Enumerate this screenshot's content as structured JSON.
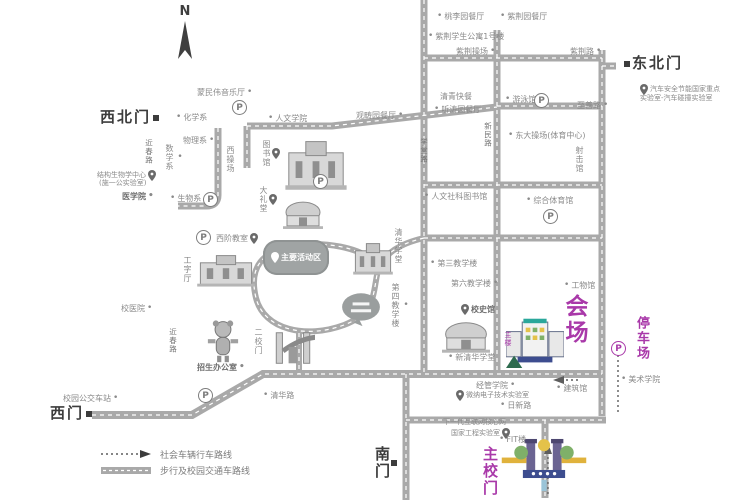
{
  "compass_label": "N",
  "colors": {
    "road": "#a9a9a9",
    "label": "#8a8a8a",
    "dark": "#3c3c3c",
    "accent": "#a939a9"
  },
  "legend": {
    "items": [
      {
        "icon": "dotted-route-icon",
        "label": "社会车辆行车路线"
      },
      {
        "icon": "road-icon",
        "label": "步行及校园交通车路线"
      }
    ]
  },
  "labels": [
    {
      "name": "northwest-gate",
      "text": "西北门",
      "x": 100,
      "y": 110,
      "cls": "gate",
      "marker": "sq-right"
    },
    {
      "name": "northeast-gate",
      "text": "东北门",
      "x": 624,
      "y": 56,
      "cls": "gate",
      "marker": "sq-left"
    },
    {
      "name": "west-gate",
      "text": "西门",
      "x": 50,
      "y": 406,
      "cls": "gate",
      "marker": "sq-right"
    },
    {
      "name": "south-gate",
      "text": "南门",
      "x": 374,
      "y": 446,
      "cls": "gate v",
      "marker": "sq-top"
    },
    {
      "name": "main-campus-gate",
      "text": "主校门",
      "x": 482,
      "y": 446,
      "cls": "gate v accent"
    },
    {
      "name": "venue",
      "text": "会场",
      "x": 562,
      "y": 294,
      "cls": "v accent big"
    },
    {
      "name": "parking-lot",
      "text": "停车场",
      "x": 635,
      "y": 316,
      "cls": "v accent mid"
    },
    {
      "name": "main-building",
      "text": "主楼",
      "x": 504,
      "y": 331,
      "cls": "v accent tiny"
    },
    {
      "name": "auto-safety-lab-line1",
      "text": "汽车安全节能国家重点",
      "x": 640,
      "y": 84,
      "cls": "tiny",
      "marker": "pin-left"
    },
    {
      "name": "auto-safety-lab-line2",
      "text": "实验室-汽车碰撞实验室",
      "x": 640,
      "y": 95,
      "cls": "tiny"
    },
    {
      "name": "mengminwei-hall",
      "text": "蒙民伟音乐厅",
      "x": 197,
      "y": 88,
      "marker": "dot-right"
    },
    {
      "name": "taoliyuan-canteen",
      "text": "桃李园餐厅",
      "x": 437,
      "y": 12,
      "marker": "dot-left"
    },
    {
      "name": "zijinyuan-canteen",
      "text": "紫荆园餐厅",
      "x": 500,
      "y": 12,
      "marker": "dot-left"
    },
    {
      "name": "zijing-dorm-1",
      "text": "紫荆学生公寓1号楼",
      "x": 428,
      "y": 32,
      "marker": "dot-left"
    },
    {
      "name": "zijing-playground",
      "text": "紫荆操场",
      "x": 456,
      "y": 47,
      "marker": "dot-right"
    },
    {
      "name": "zijing-road",
      "text": "紫荆路",
      "x": 570,
      "y": 47,
      "marker": "dot-right"
    },
    {
      "name": "qingqing-fastfood",
      "text": "清青快餐",
      "x": 440,
      "y": 93
    },
    {
      "name": "tingtaoyuan-canteen",
      "text": "听涛园餐厅",
      "x": 434,
      "y": 105,
      "marker": "dot-left"
    },
    {
      "name": "guanchouyuan-canteen",
      "text": "观畴园餐厅",
      "x": 356,
      "y": 111,
      "marker": "dot-right"
    },
    {
      "name": "swimming-pool",
      "text": "游泳馆",
      "x": 505,
      "y": 95,
      "marker": "dot-left"
    },
    {
      "name": "zhishan-road",
      "text": "至善路",
      "x": 577,
      "y": 101,
      "marker": "dot-right"
    },
    {
      "name": "xinmin-road",
      "text": "新民路",
      "x": 484,
      "y": 122,
      "cls": "v roadname"
    },
    {
      "name": "xuetang-road",
      "text": "学堂路",
      "x": 420,
      "y": 138,
      "cls": "v roadname"
    },
    {
      "name": "jinchun-road-north",
      "text": "近春路",
      "x": 145,
      "y": 139,
      "cls": "v roadname"
    },
    {
      "name": "jinchun-road-south",
      "text": "近春路",
      "x": 169,
      "y": 328,
      "cls": "v roadname"
    },
    {
      "name": "qinghua-road",
      "text": "清华路",
      "x": 263,
      "y": 391,
      "marker": "dot-left"
    },
    {
      "name": "rixin-road",
      "text": "日新路",
      "x": 500,
      "y": 401,
      "marker": "dot-left"
    },
    {
      "name": "chemistry-dept",
      "text": "化学系",
      "x": 176,
      "y": 113,
      "marker": "dot-left"
    },
    {
      "name": "humanities-school",
      "text": "人文学院",
      "x": 268,
      "y": 114,
      "marker": "dot-left"
    },
    {
      "name": "physics-dept",
      "text": "物理系",
      "x": 183,
      "y": 136,
      "marker": "dot-right"
    },
    {
      "name": "math-dept",
      "text": "数学系",
      "x": 165,
      "y": 144,
      "cls": "v",
      "marker": "dot-top"
    },
    {
      "name": "west-playground",
      "text": "西操场",
      "x": 226,
      "y": 146,
      "cls": "v"
    },
    {
      "name": "structural-biology-center",
      "text": "结构生物学中心",
      "x": 97,
      "y": 170,
      "cls": "tiny",
      "marker": "pin-right"
    },
    {
      "name": "shiyigong-lab",
      "text": "(施一公实验室)",
      "x": 99,
      "y": 180,
      "cls": "tiny"
    },
    {
      "name": "medical-school",
      "text": "医学院",
      "x": 122,
      "y": 192,
      "cls": "semib",
      "marker": "dot-right"
    },
    {
      "name": "biology-dept",
      "text": "生物系",
      "x": 170,
      "y": 194,
      "marker": "dot-left"
    },
    {
      "name": "library",
      "text": "图书馆",
      "x": 262,
      "y": 140,
      "cls": "v",
      "marker": "pin-top"
    },
    {
      "name": "grand-auditorium",
      "text": "大礼堂",
      "x": 259,
      "y": 186,
      "cls": "v",
      "marker": "pin-top"
    },
    {
      "name": "xijie-classroom",
      "text": "西阶教室",
      "x": 216,
      "y": 233,
      "marker": "pin-right"
    },
    {
      "name": "main-activity-area",
      "text": "主要活动区",
      "x": 263,
      "y": 240,
      "cls": "bubble",
      "marker": "pin-left"
    },
    {
      "name": "qinghua-xuetang",
      "text": "清华学堂",
      "x": 394,
      "y": 228,
      "cls": "v"
    },
    {
      "name": "gongziting",
      "text": "工字厅",
      "x": 183,
      "y": 256,
      "cls": "v"
    },
    {
      "name": "second-gate",
      "text": "二校门",
      "x": 254,
      "y": 328,
      "cls": "v"
    },
    {
      "name": "no4-teaching-building",
      "text": "第四教学楼",
      "x": 391,
      "y": 283,
      "cls": "v",
      "marker": "dot-top"
    },
    {
      "name": "east-playground",
      "text": "东大操场(体育中心)",
      "x": 508,
      "y": 131,
      "marker": "dot-left"
    },
    {
      "name": "shooting-range",
      "text": "射击馆",
      "x": 575,
      "y": 146,
      "cls": "v"
    },
    {
      "name": "humanities-library",
      "text": "人文社科图书馆",
      "x": 424,
      "y": 192,
      "marker": "dot-left"
    },
    {
      "name": "gymnasium",
      "text": "综合体育馆",
      "x": 526,
      "y": 196,
      "marker": "dot-left"
    },
    {
      "name": "no3-teaching-building",
      "text": "第三教学楼",
      "x": 430,
      "y": 259,
      "marker": "dot-left"
    },
    {
      "name": "no6-teaching-building",
      "text": "第六教学楼",
      "x": 451,
      "y": 279,
      "marker": "dot-right"
    },
    {
      "name": "engineering-physics-building",
      "text": "工物馆",
      "x": 564,
      "y": 281,
      "marker": "dot-left"
    },
    {
      "name": "history-museum",
      "text": "校史馆",
      "x": 461,
      "y": 304,
      "cls": "semib",
      "marker": "pin-left"
    },
    {
      "name": "new-tsinghua-hall",
      "text": "新清华学堂",
      "x": 448,
      "y": 353,
      "marker": "dot-left"
    },
    {
      "name": "school-hospital",
      "text": "校医院",
      "x": 121,
      "y": 304,
      "marker": "dot-right"
    },
    {
      "name": "admissions-office",
      "text": "招生办公室",
      "x": 197,
      "y": 363,
      "cls": "semib",
      "marker": "dot-right"
    },
    {
      "name": "campus-bus-stop",
      "text": "校园公交车站",
      "x": 63,
      "y": 394,
      "marker": "dot-right"
    },
    {
      "name": "art-school",
      "text": "美术学院",
      "x": 621,
      "y": 375,
      "marker": "dot-left"
    },
    {
      "name": "sem-school",
      "text": "经管学院",
      "x": 476,
      "y": 381,
      "marker": "dot-right"
    },
    {
      "name": "architecture-building",
      "text": "建筑馆",
      "x": 556,
      "y": 384,
      "marker": "dot-left"
    },
    {
      "name": "microelectronics-lab",
      "text": "微纳电子技术实验室",
      "x": 456,
      "y": 390,
      "cls": "tiny",
      "marker": "pin-left"
    },
    {
      "name": "ngi-lab-line1",
      "text": "下一代互联网核心网",
      "x": 443,
      "y": 419,
      "cls": "tiny"
    },
    {
      "name": "ngi-lab-line2",
      "text": "国家工程实验室",
      "x": 451,
      "y": 428,
      "cls": "tiny",
      "marker": "pin-right"
    },
    {
      "name": "fit-building",
      "text": "FIT楼",
      "x": 499,
      "y": 435,
      "marker": "dot-left"
    }
  ],
  "parking_icons": [
    {
      "name": "parking-mengminwei",
      "x": 232,
      "y": 100
    },
    {
      "name": "parking-biology",
      "x": 203,
      "y": 192
    },
    {
      "name": "parking-auditorium",
      "x": 313,
      "y": 174
    },
    {
      "name": "parking-xijie",
      "x": 196,
      "y": 230
    },
    {
      "name": "parking-swimming",
      "x": 534,
      "y": 93
    },
    {
      "name": "parking-gymnasium",
      "x": 543,
      "y": 209
    },
    {
      "name": "parking-west-gate",
      "x": 198,
      "y": 388
    },
    {
      "name": "parking-venue",
      "x": 611,
      "y": 341,
      "accent": true
    }
  ],
  "illustrations": [
    {
      "name": "library-building-illustration",
      "type": "building",
      "x": 282,
      "y": 136,
      "w": 68,
      "h": 56
    },
    {
      "name": "auditorium-dome-illustration",
      "type": "dome",
      "x": 278,
      "y": 197,
      "w": 50,
      "h": 34
    },
    {
      "name": "qinghua-xuetang-building-illustration",
      "type": "building",
      "x": 351,
      "y": 240,
      "w": 44,
      "h": 36
    },
    {
      "name": "gongziting-building-illustration",
      "type": "building",
      "x": 194,
      "y": 252,
      "w": 64,
      "h": 36
    },
    {
      "name": "second-gate-illustration",
      "type": "arch",
      "x": 271,
      "y": 321,
      "w": 44,
      "h": 47
    },
    {
      "name": "speech-bubble-sculpture-illustration",
      "type": "bubble",
      "x": 340,
      "y": 291,
      "w": 42,
      "h": 38
    },
    {
      "name": "mascot-illustration",
      "type": "mascot",
      "x": 202,
      "y": 318,
      "w": 42,
      "h": 46
    },
    {
      "name": "new-tsinghua-hall-illustration",
      "type": "dome",
      "x": 436,
      "y": 317,
      "w": 60,
      "h": 38
    },
    {
      "name": "main-building-illustration",
      "type": "mainbuilding",
      "x": 506,
      "y": 312,
      "w": 58,
      "h": 56
    },
    {
      "name": "main-gate-illustration",
      "type": "maingate",
      "x": 500,
      "y": 434,
      "w": 88,
      "h": 62
    }
  ]
}
